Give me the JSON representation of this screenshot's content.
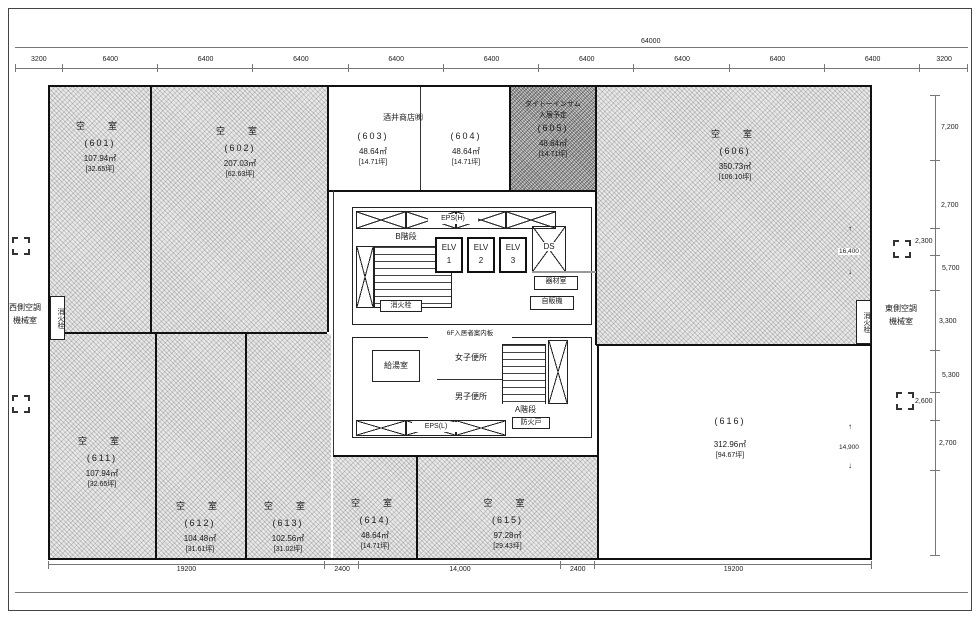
{
  "dims": {
    "overall_top": "64000",
    "top_segments": [
      "3200",
      "6400",
      "6400",
      "6400",
      "6400",
      "6400",
      "6400",
      "6400",
      "6400",
      "6400",
      "3200"
    ],
    "bottom_segments": [
      "19200",
      "2400",
      "14,000",
      "2400",
      "19200"
    ],
    "right_column": [
      "7,200",
      "2,700",
      "2,300",
      "5,700",
      "3,300",
      "5,300",
      "2,600",
      "2,700"
    ],
    "span_upper": "16,400",
    "span_lower": "14,900",
    "arrow_up": "↑",
    "arrow_down": "↓"
  },
  "header": {
    "tenant_over_603_604": "酒井商店㈱"
  },
  "rooms": [
    {
      "status": "空　室",
      "number": "(601)",
      "area": "107.94㎡",
      "tsubo": "[32.65坪]"
    },
    {
      "status": "空　室",
      "number": "(602)",
      "area": "207.03㎡",
      "tsubo": "[62.63坪]"
    },
    {
      "status": "",
      "number": "(603)",
      "area": "48.64㎡",
      "tsubo": "[14.71坪]"
    },
    {
      "status": "",
      "number": "(604)",
      "area": "48.64㎡",
      "tsubo": "[14.71坪]"
    },
    {
      "status": "",
      "company": "ダイトーインサム",
      "note": "入居予定",
      "number": "(605)",
      "area": "48.64㎡",
      "tsubo": "[14.71坪]"
    },
    {
      "status": "空　室",
      "number": "(606)",
      "area": "350.73㎡",
      "tsubo": "[106.10坪]"
    },
    {
      "status": "空　室",
      "number": "(611)",
      "area": "107.94㎡",
      "tsubo": "[32.65坪]"
    },
    {
      "status": "空　室",
      "number": "(612)",
      "area": "104.48㎡",
      "tsubo": "[31.61坪]"
    },
    {
      "status": "空　室",
      "number": "(613)",
      "area": "102.56㎡",
      "tsubo": "[31.02坪]"
    },
    {
      "status": "空　室",
      "number": "(614)",
      "area": "48.64㎡",
      "tsubo": "[14.71坪]"
    },
    {
      "status": "空　室",
      "number": "(615)",
      "area": "97.28㎡",
      "tsubo": "[29.43坪]"
    },
    {
      "status": "",
      "number": "(616)",
      "area": "312.96㎡",
      "tsubo": "[94.67坪]"
    }
  ],
  "core": {
    "eps_top": "EPS(H)",
    "eps_bottom": "EPS(L)",
    "stair_b": "B階段",
    "stair_a": "A階段",
    "hydrant": "消火栓",
    "elv": "ELV",
    "elv_numbers": [
      "1",
      "2",
      "3"
    ],
    "ds": "DS",
    "equipment_room": "器材室",
    "vending": "自販機",
    "info_board": "6F入居者案内板",
    "kitchenette": "給湯室",
    "womens_toilet": "女子便所",
    "mens_toilet": "男子便所",
    "fire_door": "防火戸"
  },
  "side": {
    "west_line1": "西側空調",
    "west_line2": "機械室",
    "east_line1": "東側空調",
    "east_line2": "機械室",
    "west_shaft": "消火栓",
    "east_shaft": "消火栓"
  }
}
